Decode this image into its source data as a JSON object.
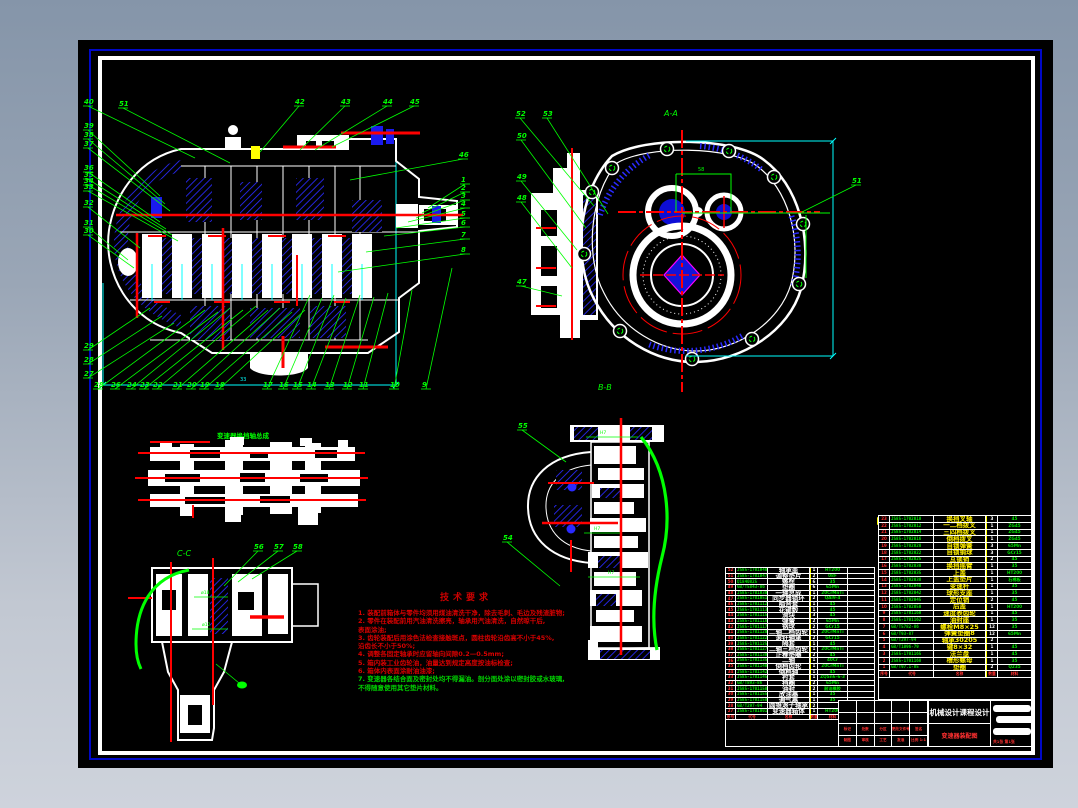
{
  "palette": {
    "green": "#00ff00",
    "red": "#ff0000",
    "cyan": "#00ffff",
    "yellow": "#ffff00",
    "hatch_blue": "#2a2aff",
    "deep_blue": "#1313d8",
    "magenta": "#ff00ff",
    "white": "#ffffff"
  },
  "labels": {
    "section_aa": "A-A",
    "section_bb": "B-B",
    "section_cc": "C-C",
    "shift_assembly_title": "变速器换挡轴总成",
    "dim_bottom": "33",
    "dim_center": "58",
    "fit_h7": "H7",
    "dia18": "ø18",
    "dia12": "ø12"
  },
  "tech_notes": {
    "title": "技术要求",
    "lines": [
      {
        "t": "1. 装配前箱体与零件均须用煤油清洗干净，除去毛刺、毛边及残渣脏物;",
        "c": "r"
      },
      {
        "t": "2. 零件在装配前用汽油清洗擦亮，轴承用汽油清洗，自然晾干后,",
        "c": "r"
      },
      {
        "t": "表面涂油;",
        "c": "r"
      },
      {
        "t": "3. 齿轮装配后用涂色法检查接触斑点，圆柱齿轮沿齿高不小于45%,",
        "c": "r"
      },
      {
        "t": "沿齿长不小于50%;",
        "c": "r"
      },
      {
        "t": "4. 调整各固定轴承时应留轴向间隙0.2—0.5mm;",
        "c": "r"
      },
      {
        "t": "5. 箱内装工业齿轮油，油量达到规定高度按油标检查;",
        "c": "r"
      },
      {
        "t": "6. 箱体内表面涂耐油油漆;",
        "c": "r"
      },
      {
        "t": "7. 变速器各结合面及密封处均不得漏油。剖分面处涂以密封胶或水玻璃,",
        "c": "g"
      },
      {
        "t": "不得随意使用其它垫片材料。",
        "c": "g"
      }
    ]
  },
  "callouts": {
    "main_left": [
      [
        "40",
        84,
        104,
        195,
        158
      ],
      [
        "51",
        119,
        106,
        230,
        163
      ],
      [
        "39",
        84,
        128,
        160,
        196
      ],
      [
        "38",
        84,
        137,
        165,
        204
      ],
      [
        "37",
        84,
        146,
        170,
        211
      ],
      [
        "36",
        84,
        170,
        160,
        222
      ],
      [
        "35",
        84,
        177,
        166,
        229
      ],
      [
        "34",
        84,
        183,
        172,
        235
      ],
      [
        "33",
        84,
        189,
        178,
        241
      ],
      [
        "32",
        84,
        205,
        140,
        248
      ],
      [
        "31",
        84,
        225,
        128,
        260
      ],
      [
        "30",
        84,
        233,
        134,
        268
      ],
      [
        "29",
        84,
        348,
        150,
        308
      ],
      [
        "28",
        84,
        362,
        162,
        316
      ],
      [
        "27",
        84,
        376,
        174,
        323
      ]
    ],
    "main_top": [
      [
        "42",
        295,
        104,
        260,
        152
      ],
      [
        "43",
        341,
        104,
        300,
        150
      ],
      [
        "44",
        383,
        104,
        315,
        150
      ],
      [
        "45",
        410,
        104,
        332,
        147
      ]
    ],
    "main_right": [
      [
        "46",
        459,
        157,
        350,
        180
      ],
      [
        "1",
        461,
        182,
        428,
        208
      ],
      [
        "2",
        461,
        190,
        422,
        213
      ],
      [
        "3",
        461,
        198,
        416,
        218
      ],
      [
        "4",
        461,
        206,
        408,
        222
      ],
      [
        "5",
        461,
        216,
        396,
        228
      ],
      [
        "6",
        461,
        225,
        384,
        236
      ],
      [
        "7",
        461,
        237,
        366,
        252
      ],
      [
        "8",
        461,
        252,
        338,
        272
      ]
    ],
    "main_bottom": [
      [
        "28",
        94,
        387,
        205,
        310
      ],
      [
        "26",
        111,
        387,
        218,
        312
      ],
      [
        "24",
        127,
        387,
        230,
        308
      ],
      [
        "23",
        140,
        387,
        243,
        310
      ],
      [
        "22",
        153,
        387,
        256,
        306
      ],
      [
        "21",
        173,
        387,
        268,
        310
      ],
      [
        "20",
        187,
        387,
        280,
        308
      ],
      [
        "19",
        200,
        387,
        292,
        312
      ],
      [
        "18",
        215,
        387,
        305,
        310
      ],
      [
        "17",
        263,
        387,
        310,
        295
      ],
      [
        "16",
        279,
        387,
        322,
        298
      ],
      [
        "15",
        293,
        387,
        334,
        295
      ],
      [
        "14",
        307,
        387,
        346,
        298
      ],
      [
        "13",
        325,
        387,
        360,
        295
      ],
      [
        "12",
        343,
        387,
        374,
        297
      ],
      [
        "11",
        359,
        387,
        388,
        293
      ],
      [
        "10",
        390,
        387,
        412,
        290
      ],
      [
        "9",
        422,
        387,
        452,
        268
      ]
    ],
    "aa": [
      [
        "52",
        516,
        116,
        594,
        206
      ],
      [
        "53",
        543,
        116,
        608,
        214
      ],
      [
        "50",
        517,
        138,
        586,
        228
      ],
      [
        "49",
        517,
        179,
        577,
        250
      ],
      [
        "48",
        517,
        200,
        572,
        268
      ],
      [
        "47",
        517,
        284,
        562,
        296
      ],
      [
        "51",
        852,
        183,
        802,
        212
      ]
    ],
    "bb": [
      [
        "55",
        518,
        428,
        566,
        462
      ],
      [
        "54",
        503,
        540,
        560,
        586
      ]
    ],
    "cc": [
      [
        "56",
        254,
        549,
        224,
        586
      ],
      [
        "57",
        274,
        549,
        238,
        582
      ],
      [
        "58",
        293,
        549,
        252,
        579
      ]
    ]
  },
  "parts_table_left": {
    "headers": [
      "序号",
      "代号",
      "名称",
      "数量",
      "材料",
      "备注"
    ],
    "rows": [
      [
        "52",
        "JS85-1701040",
        "轴承盖",
        "1",
        "HT200",
        ""
      ],
      [
        "51",
        "JS85-1701047",
        "调整垫片",
        "2",
        "08F",
        ""
      ],
      [
        "50",
        "Q1840825",
        "螺栓",
        "6",
        "35",
        ""
      ],
      [
        "49",
        "GB/T5843-86",
        "垫圈",
        "6",
        "65Mn",
        ""
      ],
      [
        "48",
        "JS85-1701030",
        "一轴总成",
        "1",
        "20CrMnTi",
        ""
      ],
      [
        "47",
        "JS85-1701051",
        "同步器锁环",
        "2",
        "QAl9-4",
        ""
      ],
      [
        "46",
        "JS85-1701112",
        "啮合套",
        "1",
        "45",
        ""
      ],
      [
        "45",
        "JS85-1701113",
        "花键毂",
        "1",
        "45",
        ""
      ],
      [
        "44",
        "JS85-1701115",
        "滑块",
        "3",
        "45",
        ""
      ],
      [
        "43",
        "JS85-1701116",
        "弹簧",
        "2",
        "65Mn",
        ""
      ],
      [
        "42",
        "JS85-1701117",
        "钢球",
        "2",
        "GCr15",
        ""
      ],
      [
        "41",
        "JS85-1701120",
        "二轴二档齿轮",
        "1",
        "20CrMnTi",
        ""
      ],
      [
        "40",
        "JS85-1701122",
        "滚针轴承",
        "2",
        "GCr15",
        ""
      ],
      [
        "39",
        "JS85-1701125",
        "隔套",
        "1",
        "45",
        ""
      ],
      [
        "38",
        "JS85-1701127",
        "二轴三档齿轮",
        "1",
        "20CrMnTi",
        ""
      ],
      [
        "37",
        "JS85-1701130",
        "止推垫圈",
        "2",
        "45",
        ""
      ],
      [
        "36",
        "JS85-1701135",
        "二轴",
        "1",
        "40Cr",
        ""
      ],
      [
        "35",
        "JS85-1701140",
        "倒档齿轮",
        "1",
        "20CrMnTi",
        ""
      ],
      [
        "34",
        "JS85-1701142",
        "倒档轴",
        "1",
        "45",
        ""
      ],
      [
        "33",
        "JS85-1701145",
        "衬套",
        "1",
        "ZQSn6-6-3",
        ""
      ],
      [
        "32",
        "GB/T893-86",
        "挡圈",
        "2",
        "65Mn",
        ""
      ],
      [
        "31",
        "JS85-1701150",
        "油封",
        "2",
        "耐油橡胶",
        ""
      ],
      [
        "30",
        "JS85-1701155",
        "放油塞",
        "1",
        "35",
        ""
      ],
      [
        "29",
        "JS85-1701158",
        "通气塞",
        "1",
        "35",
        ""
      ],
      [
        "28",
        "GB/T297-94",
        "圆锥滚子轴承",
        "2",
        "",
        ""
      ],
      [
        "27",
        "JS85-1701001",
        "变速器箱体",
        "1",
        "HT200",
        ""
      ]
    ]
  },
  "parts_table_right": {
    "headers": [
      "序号",
      "代号",
      "名称",
      "数量",
      "材料",
      "备注"
    ],
    "rows": [
      [
        "23",
        "JS85-1702010",
        "换挡叉轴",
        "3",
        "45"
      ],
      [
        "22",
        "JS85-1702012",
        "一二档拨叉",
        "1",
        "ZG45"
      ],
      [
        "21",
        "JS85-1702014",
        "三四档拨叉",
        "1",
        "ZG45"
      ],
      [
        "20",
        "JS85-1702016",
        "倒档拨叉",
        "1",
        "ZG45"
      ],
      [
        "19",
        "JS85-1702020",
        "自锁弹簧",
        "3",
        "65Mn"
      ],
      [
        "18",
        "JS85-1702022",
        "自锁钢球",
        "3",
        "GCr15"
      ],
      [
        "17",
        "JS85-1702025",
        "互锁销",
        "2",
        "45"
      ],
      [
        "16",
        "JS85-1702030",
        "换挡摇臂",
        "1",
        "35"
      ],
      [
        "15",
        "JS85-1702035",
        "上盖",
        "1",
        "HT200"
      ],
      [
        "14",
        "JS85-1702038",
        "上盖垫片",
        "1",
        "石棉板"
      ],
      [
        "13",
        "JS85-1702040",
        "变速杆",
        "1",
        "35"
      ],
      [
        "12",
        "JS85-1702042",
        "球形支座",
        "1",
        "35"
      ],
      [
        "11",
        "JS85-1702045",
        "定位销",
        "2",
        "45"
      ],
      [
        "10",
        "JS85-1702050",
        "后盖",
        "1",
        "HT200"
      ],
      [
        "9",
        "JS85-1701160",
        "速度表齿轮",
        "1",
        "45"
      ],
      [
        "8",
        "JS85-1701162",
        "油封座",
        "1",
        "35"
      ],
      [
        "7",
        "GB/T5782-86",
        "螺栓M8×25",
        "12",
        "35"
      ],
      [
        "6",
        "GB/T93-87",
        "弹簧垫圈8",
        "12",
        "65Mn"
      ],
      [
        "5",
        "GB/T297-94",
        "轴承30205",
        "2",
        ""
      ],
      [
        "4",
        "GB/T1096-79",
        "键8×32",
        "1",
        "45"
      ],
      [
        "3",
        "JS85-1701165",
        "法兰盘",
        "1",
        "45"
      ],
      [
        "2",
        "JS85-1701168",
        "槽形螺母",
        "1",
        "35"
      ],
      [
        "1",
        "GB/T97.1-85",
        "垫圈",
        "2",
        "Q235"
      ]
    ]
  },
  "title_block": {
    "org": "机械设计课程设计",
    "title": "变速器装配图",
    "rev_labels": [
      "标记",
      "处数",
      "分区",
      "更改文件号",
      "签名",
      "年月日"
    ],
    "sign_labels": [
      "制图",
      "审核",
      "工艺",
      "批准"
    ],
    "scale": "比例 1:1",
    "sheets": "共1张 第1张"
  }
}
